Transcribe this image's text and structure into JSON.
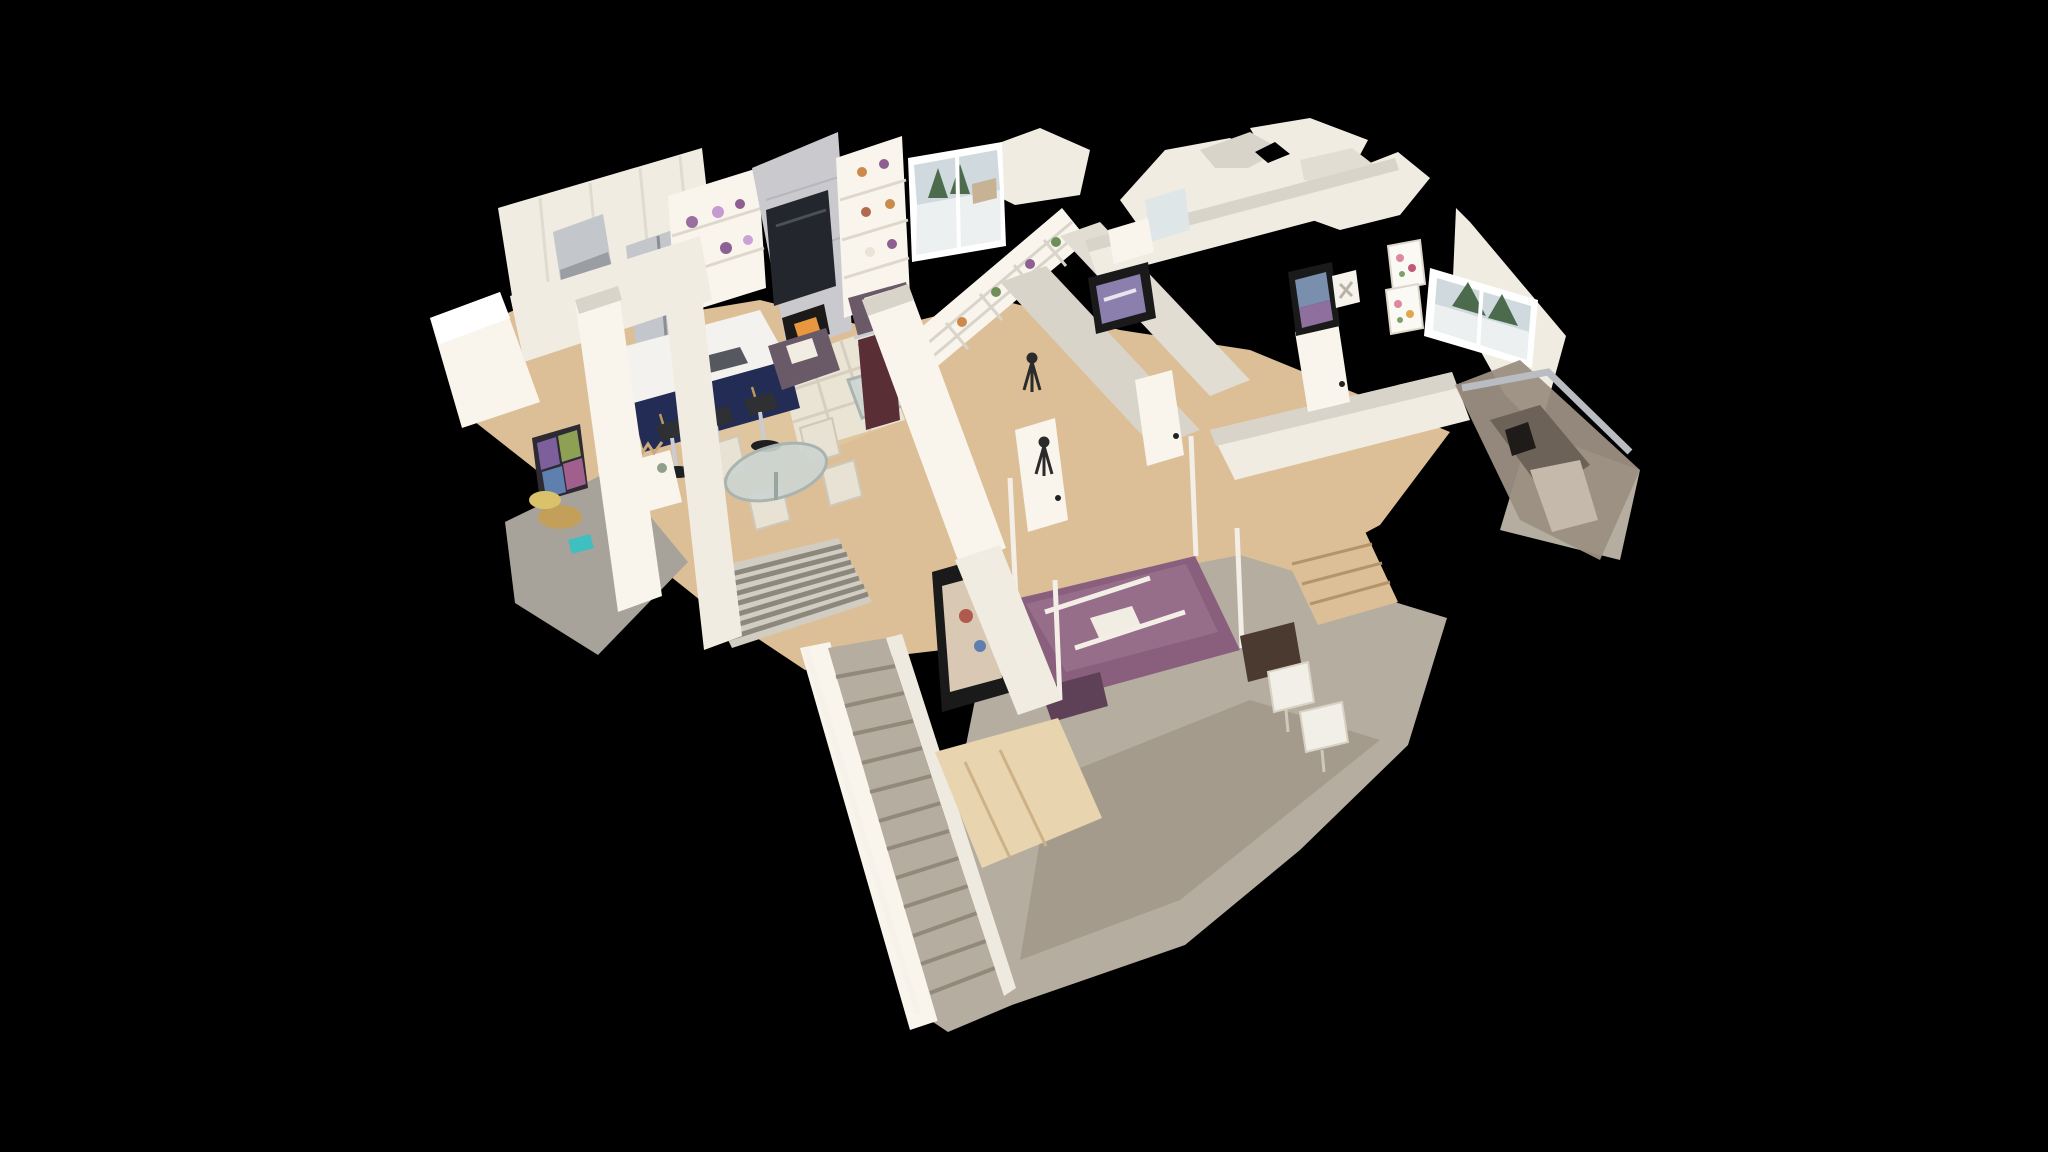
{
  "app": {
    "name": "3d-home-tour-viewer",
    "view_mode": "dollhouse",
    "chrome_visible": false
  },
  "canvas": {
    "width": 2048,
    "height": 1152,
    "background": "#000000"
  },
  "palette": {
    "background": "#000000",
    "wall": "#f1ece2",
    "wallTop": "#d9d4ca",
    "wallBright": "#f9f5ed",
    "wallShade": "#e2ddd2",
    "wood": "#dcbf97",
    "woodLight": "#e8d4ae",
    "woodDark": "#c4a276",
    "carpet": "#b5ad9f",
    "carpetDark": "#93897a",
    "tile": "#a8a39a",
    "rug": "#eae4d4",
    "rugLine": "#d6cfbf",
    "runner": "#d2cdc2",
    "runnerStripe": "#8d887e",
    "navy": "#232c55",
    "navyDark": "#1a2140",
    "gold": "#c2a05a",
    "stainless": "#c3c6ca",
    "stainlessDark": "#9a9da2",
    "marble": "#c9c9ce",
    "marbleVein": "#b2b2b9",
    "tvScreen": "#23262d",
    "fireboxDark": "#1c1a18",
    "flame": "#e8973f",
    "bedPurple": "#8a5f7d",
    "bedPurpleLight": "#9d7590",
    "bedPurpleDark": "#5e4156",
    "chairPurple": "#6a5a68",
    "cream": "#e8e2d4",
    "pillow": "#f2ede2",
    "glass": "#ccd5d2",
    "glassEdge": "#a9b4b0",
    "treeGreen": "#4c6b4c",
    "snow": "#edf0f1",
    "sky": "#cfd9de",
    "artPurple": "#8b7fae",
    "artBlue": "#7a8fae",
    "artMauve": "#8e6f9e",
    "artBeige": "#d9c9b4",
    "floralPink": "#e0889e",
    "leafGreen": "#7fa06a",
    "maroon": "#5a2e35",
    "benchBrown": "#4a3a30",
    "frameBlack": "#1a1a1a",
    "noise": "#9b8f82",
    "noiseDark": "#6d6257",
    "silver": "#b9bcc0",
    "glassPurple": "#7d5f9c",
    "glassGreen": "#8ea054",
    "glassBlue": "#5f7fae",
    "glassMagenta": "#a05f8c",
    "stepLine": "#93897a",
    "dark": "#2b2b2b"
  },
  "scene": {
    "description_regions": [
      "kitchen",
      "living-room",
      "dining-area",
      "entry-foyer",
      "hallway",
      "bathroom",
      "laundry-room",
      "primary-bedroom-purple-bed",
      "bedroom-with-window",
      "staircase",
      "lower-level-carpet-room",
      "stair-railing-scan-artifact"
    ],
    "counts": {
      "bar_stools": 3,
      "dining_chairs": 4,
      "bed_canopy_posts": 4,
      "floral_art_panels": 2,
      "visible_stair_steps": 13,
      "windows_with_outdoor_view": 2,
      "framed_artworks": 4,
      "camera_tripods": 2
    }
  }
}
